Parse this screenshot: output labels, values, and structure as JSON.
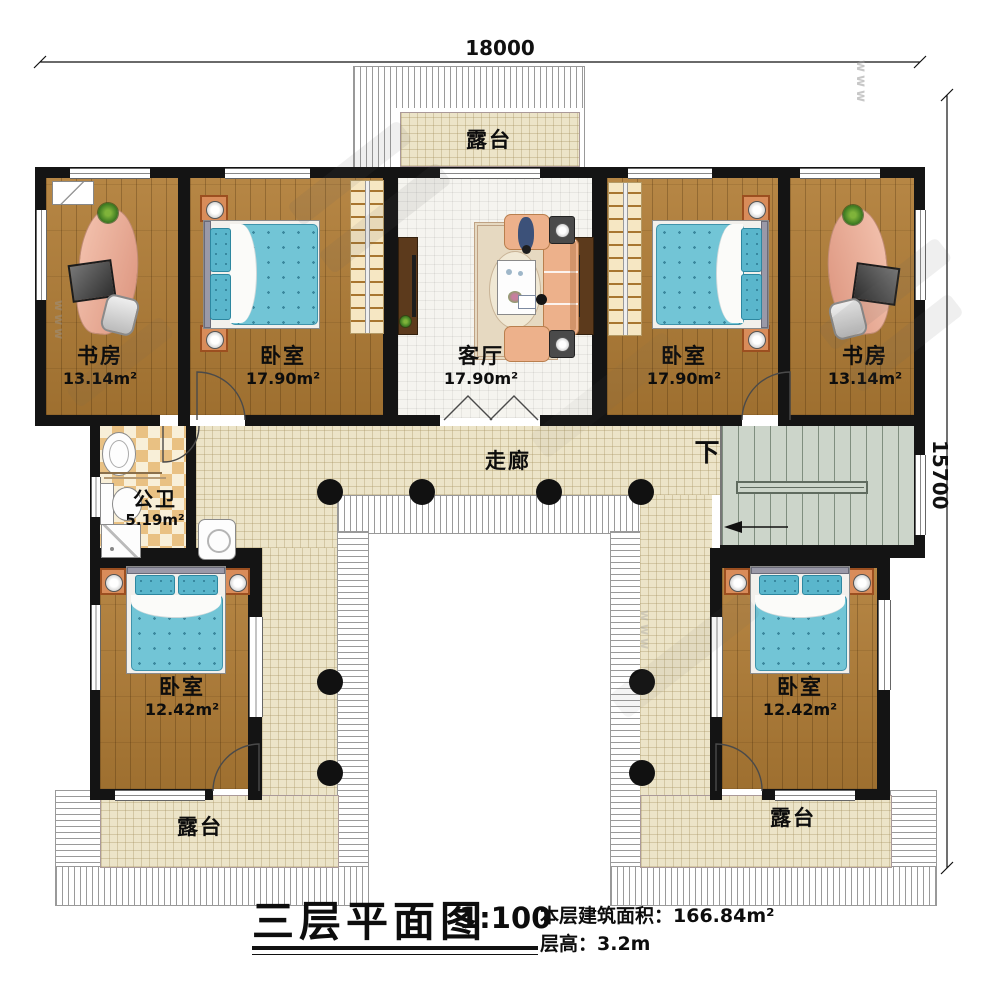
{
  "dimensions": {
    "top": "18000",
    "right": "15700"
  },
  "rooms": {
    "terrace_top": {
      "name": "露台"
    },
    "study_left": {
      "name": "书房",
      "area": "13.14m²"
    },
    "bedroom_upper_left": {
      "name": "卧室",
      "area": "17.90m²"
    },
    "living_room": {
      "name": "客厅",
      "area": "17.90m²"
    },
    "bedroom_upper_right": {
      "name": "卧室",
      "area": "17.90m²"
    },
    "study_right": {
      "name": "书房",
      "area": "13.14m²"
    },
    "bathroom": {
      "name": "公卫",
      "area": "5.19m²"
    },
    "corridor": {
      "name": "走廊"
    },
    "stair_direction": {
      "label": "下"
    },
    "bedroom_lower_left": {
      "name": "卧室",
      "area": "12.42m²"
    },
    "bedroom_lower_right": {
      "name": "卧室",
      "area": "12.42m²"
    },
    "terrace_lower_left": {
      "name": "露台"
    },
    "terrace_lower_right": {
      "name": "露台"
    }
  },
  "title_block": {
    "title": "三层平面图",
    "scale": "1:100",
    "area_line": "本层建筑面积：166.84m²",
    "height_line": "层高：3.2m"
  },
  "watermark": {
    "text": "www"
  }
}
